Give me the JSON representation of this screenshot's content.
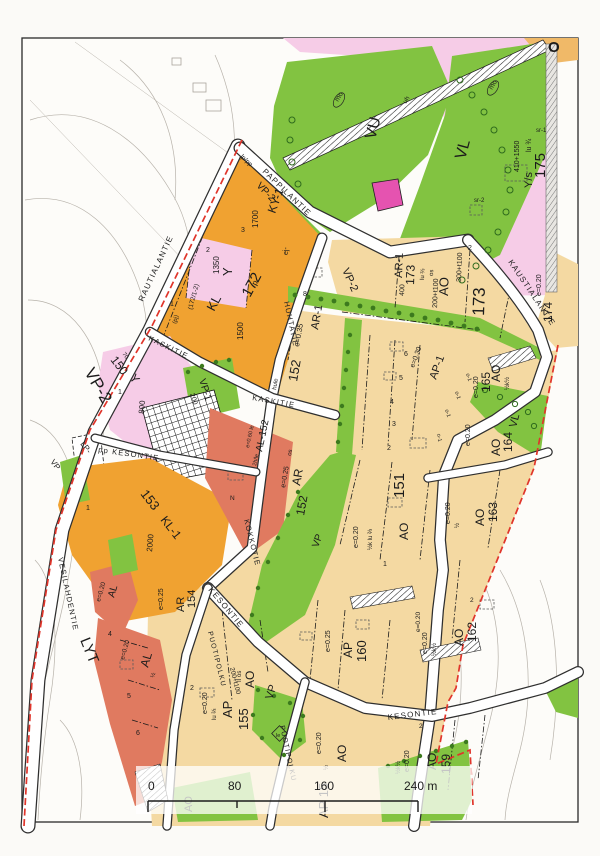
{
  "document_type": "zoning plan map (asemakaava)",
  "streets": {
    "pappilantie": "PAPPILANTIE",
    "rautialantie": "RAUTIALANTIE",
    "kaustialantie": "KAUSTIALANTIE",
    "kaskitie": "KASKITIE",
    "huhtatie": "HUHTATIE",
    "kokkotie": "KOKKOTIE",
    "kesontie": "KESONTIE",
    "pp_kesontie": "pp KESONTIE",
    "puotipolku": "PUOTIPOLKU",
    "vesilahdentie": "VESILAHDENTIE"
  },
  "zones": {
    "vu": "VU",
    "vl": "VL",
    "vp": "VP",
    "vp1": "VP-1",
    "vp2": "VP-2",
    "ao": "AO",
    "ap": "AP",
    "ar": "AR",
    "ar1": "AR-1",
    "ap1": "AP-1",
    "al": "AL",
    "al152": "AL-152",
    "kl": "KL",
    "kl1": "KL-1",
    "ky1": "KY-1",
    "y": "Y",
    "ys": "Y/s",
    "lyt": "LYT",
    "lp": "LP-"
  },
  "blocks": {
    "b150": "150",
    "b151": "151",
    "b152": "152",
    "b153": "153",
    "b154": "154",
    "b155": "155",
    "b159": "159",
    "b160": "160",
    "b162": "162",
    "b163": "163",
    "b164": "164",
    "b165": "165",
    "b172": "172",
    "b173": "173",
    "b173b": "173",
    "b174": "174",
    "b175": "175"
  },
  "params": {
    "e020": "e=0.20",
    "e025": "e=0.25",
    "e030": "e=0.30",
    "e035": "e=0.35",
    "e060": "e=0.60 le",
    "two_h_le": "2h/le",
    "c70": "70",
    "c200": "200",
    "c400": "400",
    "c800": "800",
    "c1350": "1350",
    "c1500": "1500",
    "c1700": "1700",
    "c2000": "2000",
    "c410": "410+1550",
    "c200t": "200+t100",
    "c300t": "300+t100",
    "lu23": "lu ⅔",
    "lu34": "lu ¾",
    "half": "½",
    "halfk": "½k½",
    "halflu": "½k lu ⅔",
    "ii_os": "II os",
    "os": "os",
    "hule": "hule"
  },
  "misc": {
    "mo": "mo",
    "sr1": "sr-1",
    "sr2": "sr-2",
    "o1": "o-1",
    "ej": "ej-",
    "pj": "(pj)",
    "uh": "uh",
    "n_mark": "N",
    "cap172": "(172/1-2)",
    "lp_pp": "lp/pp",
    "le": "le",
    "o_corner": "O",
    "ap15": "AP 15",
    "p": "p"
  },
  "plots": {
    "p1": "1",
    "p2": "2",
    "p3": "3",
    "p4": "4",
    "p5": "5",
    "p6": "6",
    "p8": "8"
  },
  "scale_bar": {
    "t0": "0",
    "t80": "80",
    "t160": "160",
    "t240": "240 m"
  },
  "colors": {
    "green": "#82c341",
    "tan": "#f4d9a2",
    "orange": "#f0a231",
    "pink": "#f6cce7",
    "salmon": "#e07a60",
    "magenta": "#e553b0",
    "boundary_red": "#e0352b",
    "road_white": "#ffffff"
  }
}
